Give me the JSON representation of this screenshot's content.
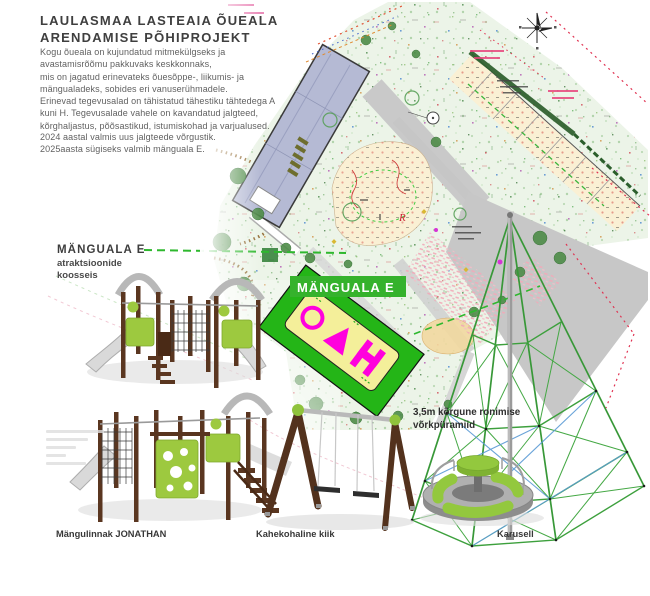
{
  "document": {
    "title": "LAULASMAA LASTEAIA ÕUEALA\nARENDAMISE PÕHIPROJEKT",
    "intro_para1": "Kogu õueala on kujundatud mitmekülgseks ja\navastamisrõõmu pakkuvaks keskkonnaks,\nmis on jagatud erinevateks õuesõppe-, liikumis- ja\nmängualadeks, sobides eri vanuserühmadele.",
    "intro_para2": "Erinevad tegevusalad on tähistatud tähestiku tähtedega A\nkuni H. Tegevusalade vahele on kavandatud jalgteed,\nkõrghaljastus, põõsastikud, istumiskohad ja varjualused.",
    "intro_para3": "2024 aastal valmis uus jalgteede võrgustik.\n2025aasta sügiseks valmib mänguala E."
  },
  "playarea": {
    "heading": "MÄNGUALA E",
    "subheading": "atraktsioonide\nkoosseis",
    "map_label": "MÄNGUALA E",
    "area_letter": "R"
  },
  "equipment": {
    "castle_caption": "Mängulinnak JONATHAN",
    "swing_caption": "Kahekohaline kiik",
    "carousel_caption": "Karusell",
    "pyramid_note": "3,5m kõrgune ronimise\nvõrkpüramiid"
  },
  "colors": {
    "equipment_green": "#9dc93f",
    "equipment_brown": "#5a3620",
    "highlight_green": "#24b517",
    "label_green": "#35b22c",
    "play_icon_magenta": "#ff00dd",
    "map_ground": "#ecf4e8",
    "boundary_red": "#e03352"
  }
}
